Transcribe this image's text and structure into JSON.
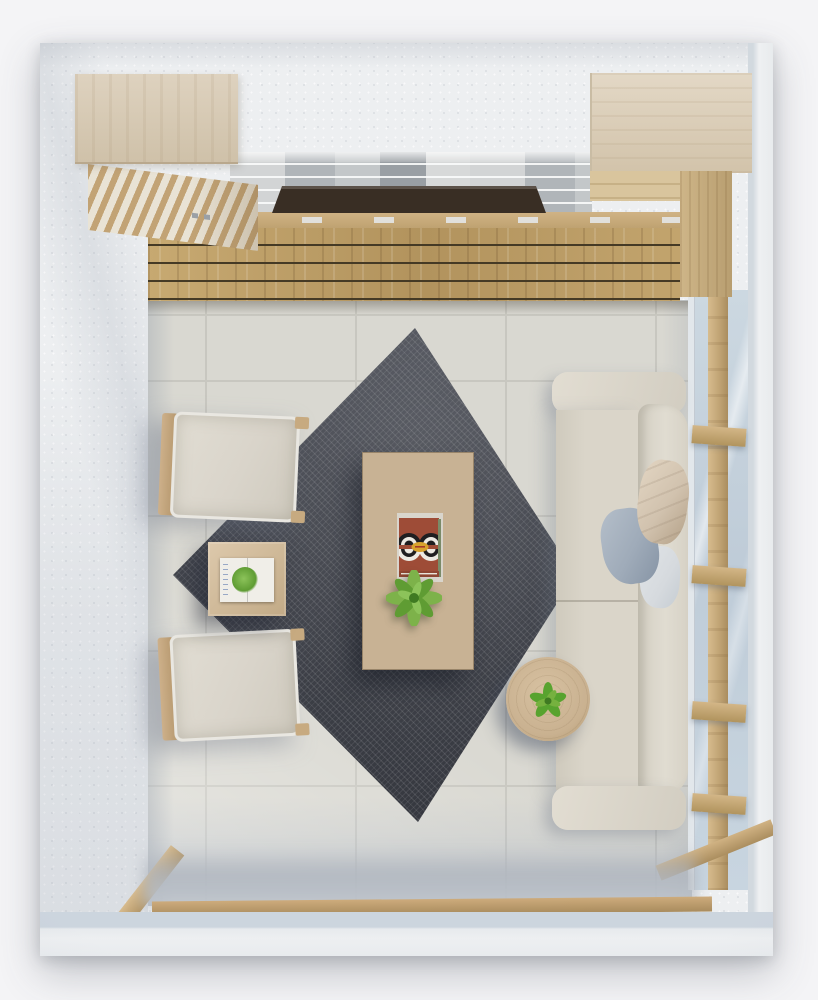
{
  "image": {
    "kind": "photorealistic 3D render",
    "subject": "living room seen from directly above (top-down floor plan view)"
  },
  "palette": {
    "page_bg": "#f4f4f6",
    "wall": "#edeff1",
    "wall_edge": "#d8dde2",
    "wall_inner": "#ccd5de",
    "floor": "#d9d8d1",
    "grout": "#c8c7c0",
    "rug": "#43464f",
    "deck_gap": "#453a25",
    "stone_a": "#d2d4d5",
    "stone_b": "#b0b5b9",
    "stone_c": "#999fa4",
    "tv": "#392e24",
    "sofa": "#dad5c9",
    "sofa_back": "#e0dcd1",
    "pillow_beige": "#d1c2ae",
    "pillow_gray": "#9fabb9",
    "pillow_white": "#d6dade",
    "chair_cushion": "#d9d4ca",
    "glass": "#c8d5e0",
    "round_table_wood": "#c9b190"
  },
  "objects": [
    {
      "label": "charcoal diamond area rug"
    },
    {
      "label": "rectangular oak coffee table"
    },
    {
      "label": "patterned art book on coffee table"
    },
    {
      "label": "green potted plant on coffee table"
    },
    {
      "label": "square wooden side table with open book"
    },
    {
      "label": "upholstered armchair with wood frame (upper left)"
    },
    {
      "label": "upholstered armchair with wood frame (lower left)"
    },
    {
      "label": "beige sofa with beige, gray and white cushions"
    },
    {
      "label": "round wooden end table with small plant"
    },
    {
      "label": "floor-to-ceiling window with wood mullions"
    },
    {
      "label": "media wall: stone veneer strip and wood plank console"
    },
    {
      "label": "wall-mounted TV seen edge-on"
    },
    {
      "label": "whitewashed wood cabinet, top-left corner"
    },
    {
      "label": "whitewashed wood cabinet, top-right corner"
    },
    {
      "label": "large-format tile floor"
    }
  ]
}
